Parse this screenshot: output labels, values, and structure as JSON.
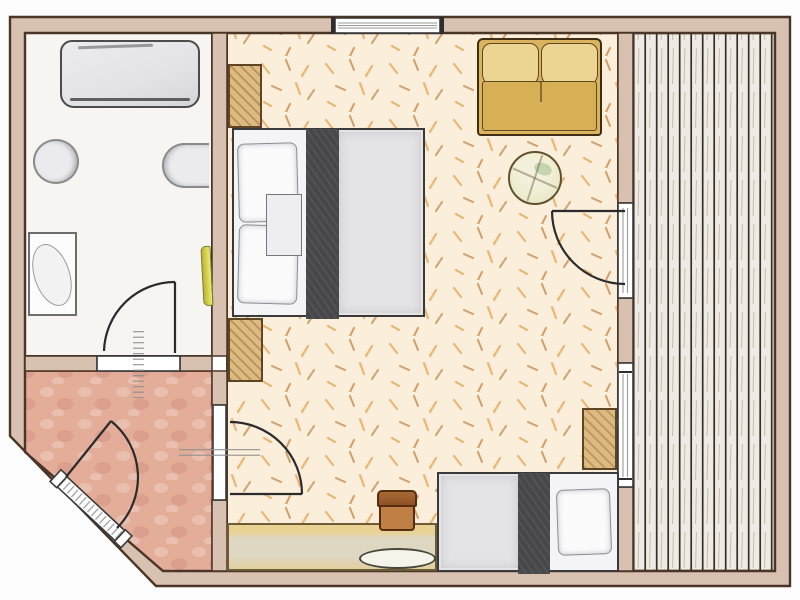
{
  "meta": {
    "type": "floor-plan",
    "style": "hand-drawn watercolor architectural sketch, top-down view",
    "description": "Floor plan of a hotel room: bathroom at top left, entry hall at bottom left with chamfered corner entrance, main room with double bed, sofa, round table, desk with chair and single bed, and a wood-plank balcony along the right side."
  },
  "rooms": [
    {
      "id": "bathroom",
      "label": "bathroom",
      "floor": "white tile"
    },
    {
      "id": "hall",
      "label": "entry hall",
      "floor": "salmon screed"
    },
    {
      "id": "bedroom",
      "label": "bedroom / living room",
      "floor": "speckled parquet"
    },
    {
      "id": "balcony",
      "label": "balcony",
      "floor": "vertical wood decking"
    }
  ],
  "furniture": [
    {
      "room": "bathroom",
      "item": "bathtub"
    },
    {
      "room": "bathroom",
      "item": "toilet"
    },
    {
      "room": "bathroom",
      "item": "wall-sink"
    },
    {
      "room": "bathroom",
      "item": "vanity-washbasin"
    },
    {
      "room": "bathroom",
      "item": "towel"
    },
    {
      "room": "bedroom",
      "item": "wardrobe-upper"
    },
    {
      "room": "bedroom",
      "item": "wardrobe-lower"
    },
    {
      "room": "bedroom",
      "item": "double-bed with two pillows and dark runner"
    },
    {
      "room": "bedroom",
      "item": "two-seat sofa"
    },
    {
      "room": "bedroom",
      "item": "round side table"
    },
    {
      "room": "bedroom",
      "item": "desk with oval tray"
    },
    {
      "room": "bedroom",
      "item": "desk chair"
    },
    {
      "room": "bedroom",
      "item": "single-bed with pillow and dark runner"
    },
    {
      "room": "bedroom",
      "item": "nightstand"
    }
  ],
  "openings": [
    {
      "id": "entrance-door",
      "wall": "chamfered south-west corner",
      "swing": "into hall"
    },
    {
      "id": "bathroom-door",
      "wall": "hall/bathroom",
      "swing": "into bathroom"
    },
    {
      "id": "bedroom-door",
      "wall": "hall/bedroom",
      "swing": "into bedroom"
    },
    {
      "id": "balcony-door",
      "wall": "bedroom/balcony",
      "swing": "into bedroom"
    },
    {
      "id": "top-window",
      "wall": "north"
    },
    {
      "id": "balcony-window",
      "wall": "bedroom/balcony"
    }
  ],
  "palette": {
    "wall": "#d9c1b1",
    "wall_line": "#4a3526",
    "bath_floor": "#f6f5f2",
    "hall_floor": "#e3ad9a",
    "bedroom_floor": "#fbeedb",
    "speckle_light": "#e8a85e",
    "speckle_dark": "#c07b3a",
    "balcony_base": "#edebe4",
    "balcony_line": "#362e27",
    "balcony_grain": "#9b8165",
    "closet_fill": "#ddba80",
    "closet_line": "#5f4526",
    "sofa_frame": "#3f2e13",
    "sofa_body": "#d9b35e",
    "sofa_back": "#ecd493",
    "table_fill": "#eeeccf",
    "chair_back": "#8f5125",
    "chair_seat": "#c07f45",
    "desk_fill": "#ded7c1",
    "desk_accent": "#e9d193",
    "bed_frame": "#3a3a3a",
    "mattress": "#e4e4e6",
    "runner": "#47474a",
    "pillow": "#fbfbfc",
    "tub_fill": "#e3e3e5",
    "fixture_fill": "#ebebed",
    "fixture_line": "#8a8a8a",
    "towel": "#d9d44c",
    "door_line": "#2b2b2b",
    "frame_white": "#ffffff"
  }
}
